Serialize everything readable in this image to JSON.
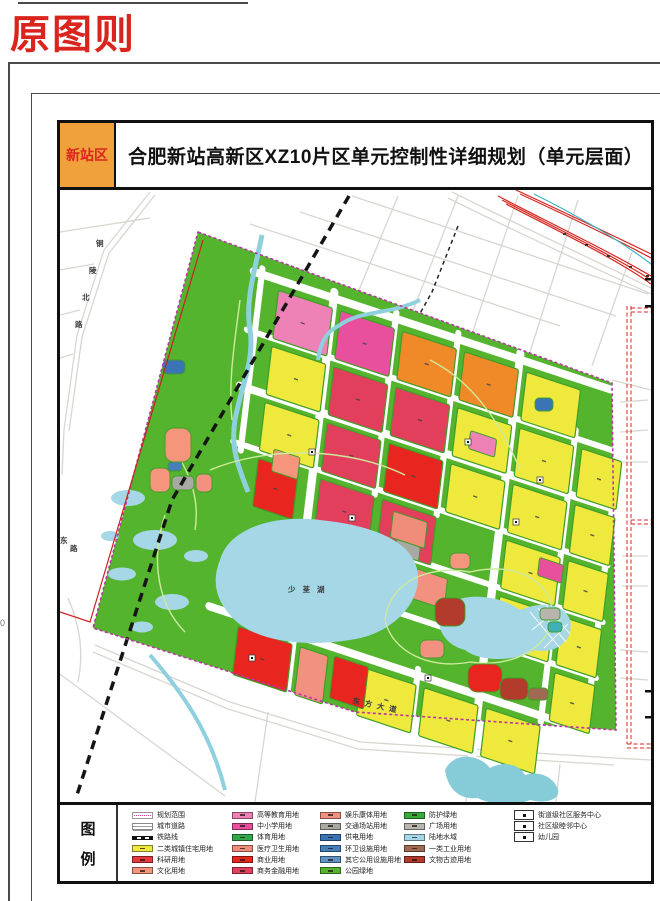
{
  "page": {
    "corner_label": "原图则",
    "side_mark": "0"
  },
  "title_bar": {
    "district_tag": "新站区",
    "title": "合肥新站高新区XZ10片区单元控制性详细规划（单元层面）"
  },
  "legend": {
    "label_chars": [
      "图",
      "例"
    ],
    "columns": [
      [
        {
          "type": "boundary",
          "label": "规划范围"
        },
        {
          "type": "road",
          "label": "城市道路"
        },
        {
          "type": "rail",
          "label": "铁路线"
        },
        {
          "type": "fill",
          "fill": "resident",
          "label": "二类城镇住宅用地"
        },
        {
          "type": "fill",
          "fill": "research",
          "label": "科研用地"
        },
        {
          "type": "fill",
          "fill": "culture",
          "label": "文化用地"
        }
      ],
      [
        {
          "type": "fill",
          "fill": "edu_hi",
          "label": "高等教育用地"
        },
        {
          "type": "fill",
          "fill": "school",
          "label": "中小学用地"
        },
        {
          "type": "fill",
          "fill": "sport",
          "label": "体育用地"
        },
        {
          "type": "fill",
          "fill": "medical",
          "label": "医疗卫生用地"
        },
        {
          "type": "fill",
          "fill": "commerce",
          "label": "商业用地"
        },
        {
          "type": "fill",
          "fill": "finance",
          "label": "商务金融用地"
        }
      ],
      [
        {
          "type": "fill",
          "fill": "leisure",
          "label": "娱乐康体用地"
        },
        {
          "type": "fill",
          "fill": "station",
          "label": "交通场站用地"
        },
        {
          "type": "fill",
          "fill": "power",
          "label": "供电用地"
        },
        {
          "type": "fill",
          "fill": "sanitation",
          "label": "环卫设施用地"
        },
        {
          "type": "fill",
          "fill": "utility",
          "label": "其它公用设施用地"
        },
        {
          "type": "fill",
          "fill": "park",
          "label": "公园绿地"
        }
      ],
      [
        {
          "type": "fill",
          "fill": "protect",
          "label": "防护绿地"
        },
        {
          "type": "fill",
          "fill": "square",
          "label": "广场用地"
        },
        {
          "type": "fill",
          "fill": "water",
          "label": "陆地水域"
        },
        {
          "type": "fill",
          "fill": "industry",
          "label": "一类工业用地"
        },
        {
          "type": "fill",
          "fill": "relic",
          "label": "文物古迹用地"
        }
      ],
      [
        {
          "type": "marker",
          "label": "街道级社区服务中心"
        },
        {
          "type": "marker",
          "label": "社区级睦邻中心"
        },
        {
          "type": "marker",
          "label": "幼儿园"
        }
      ]
    ]
  },
  "map": {
    "labels": {
      "road_left": "铜陵北路",
      "road_left_partial": "东路",
      "lake": "少荃湖",
      "road_bottom": "东方大道"
    },
    "colors": {
      "resident": "#efe93e",
      "research": "#e6393f",
      "culture": "#f4957c",
      "edu_hi": "#ee82b6",
      "school": "#e8509e",
      "sport": "#33a84b",
      "medical": "#f08d7a",
      "commerce": "#e8251f",
      "finance": "#e23f5c",
      "leisure": "#f29180",
      "station": "#a9a9a4",
      "power": "#3b74b4",
      "sanitation": "#4580ba",
      "utility": "#5e93c6",
      "park": "#55b42e",
      "protect": "#3aa93c",
      "square": "#b8b5af",
      "water": "#a6d7e6",
      "industry": "#a06a52",
      "relic": "#b23b2c",
      "orange": "#f08a28",
      "teal": "#3fb0b8",
      "stream": "#8ed0de",
      "boundary": "#b837a4",
      "redline": "#cc2020",
      "rail_corridor": "#d6251f",
      "corridor_cyan": "#3fb3c4",
      "road_gray": "#d7d6d1",
      "park_path": "#cdea9c",
      "railway_black": "#151515"
    },
    "parcels": {
      "cells": [
        [
          0,
          0,
          "edu_hi"
        ],
        [
          1,
          0,
          "school"
        ],
        [
          2,
          0,
          "orange"
        ],
        [
          3,
          0,
          "orange"
        ],
        [
          4,
          0,
          "resident"
        ],
        [
          0,
          1,
          "resident"
        ],
        [
          1,
          1,
          "finance"
        ],
        [
          2,
          1,
          "finance"
        ],
        [
          3,
          1,
          "resident"
        ],
        [
          4,
          1,
          "resident"
        ],
        [
          5,
          1,
          "resident",
          40
        ],
        [
          0,
          2,
          "resident"
        ],
        [
          1,
          2,
          "finance"
        ],
        [
          2,
          2,
          "commerce"
        ],
        [
          3,
          2,
          "resident"
        ],
        [
          4,
          2,
          "resident"
        ],
        [
          5,
          2,
          "resident",
          40
        ],
        [
          0,
          3,
          "commerce",
          40
        ],
        [
          1,
          3,
          "finance"
        ],
        [
          2,
          3,
          "finance"
        ],
        [
          4,
          3,
          "resident"
        ],
        [
          5,
          3,
          "resident",
          40
        ],
        [
          4,
          4,
          "resident"
        ],
        [
          5,
          4,
          "resident",
          40
        ],
        [
          5,
          5,
          "resident",
          40
        ],
        [
          0,
          6,
          "commerce"
        ],
        [
          1,
          6,
          "leisure",
          28
        ],
        [
          2,
          6,
          "resident"
        ],
        [
          3,
          6,
          "resident"
        ],
        [
          4,
          6,
          "resident"
        ]
      ],
      "subs": [
        [
          100,
          338,
          34,
          42,
          "commerce"
        ],
        [
          205,
          78,
          26,
          18,
          "edu_hi"
        ],
        [
          286,
          178,
          24,
          18,
          "school"
        ],
        [
          160,
          228,
          40,
          30,
          "leisure"
        ],
        [
          140,
          180,
          34,
          26,
          "medical"
        ],
        [
          146,
          206,
          24,
          14,
          "station"
        ],
        [
          18,
          158,
          26,
          22,
          "culture"
        ]
      ],
      "blobs": [
        [
          165,
          428,
          26,
          34,
          "culture"
        ],
        [
          150,
          468,
          20,
          24,
          "culture"
        ],
        [
          196,
          474,
          16,
          18,
          "leisure"
        ],
        [
          420,
          640,
          24,
          18,
          "leisure"
        ],
        [
          450,
          553,
          20,
          16,
          "culture"
        ],
        [
          435,
          598,
          30,
          28,
          "relic"
        ],
        [
          468,
          664,
          34,
          28,
          "commerce"
        ],
        [
          500,
          678,
          28,
          22,
          "relic"
        ],
        [
          528,
          688,
          20,
          12,
          "industry"
        ],
        [
          172,
          476,
          22,
          14,
          "station"
        ],
        [
          540,
          608,
          20,
          12,
          "square"
        ],
        [
          548,
          622,
          14,
          10,
          "teal"
        ],
        [
          163,
          360,
          22,
          14,
          "power"
        ],
        [
          535,
          398,
          18,
          13,
          "power"
        ],
        [
          168,
          462,
          14,
          9,
          "sanitation"
        ]
      ],
      "markers": [
        [
          312,
          452
        ],
        [
          352,
          518
        ],
        [
          468,
          442
        ],
        [
          516,
          522
        ],
        [
          428,
          678
        ],
        [
          252,
          658
        ],
        [
          540,
          480
        ]
      ]
    }
  }
}
